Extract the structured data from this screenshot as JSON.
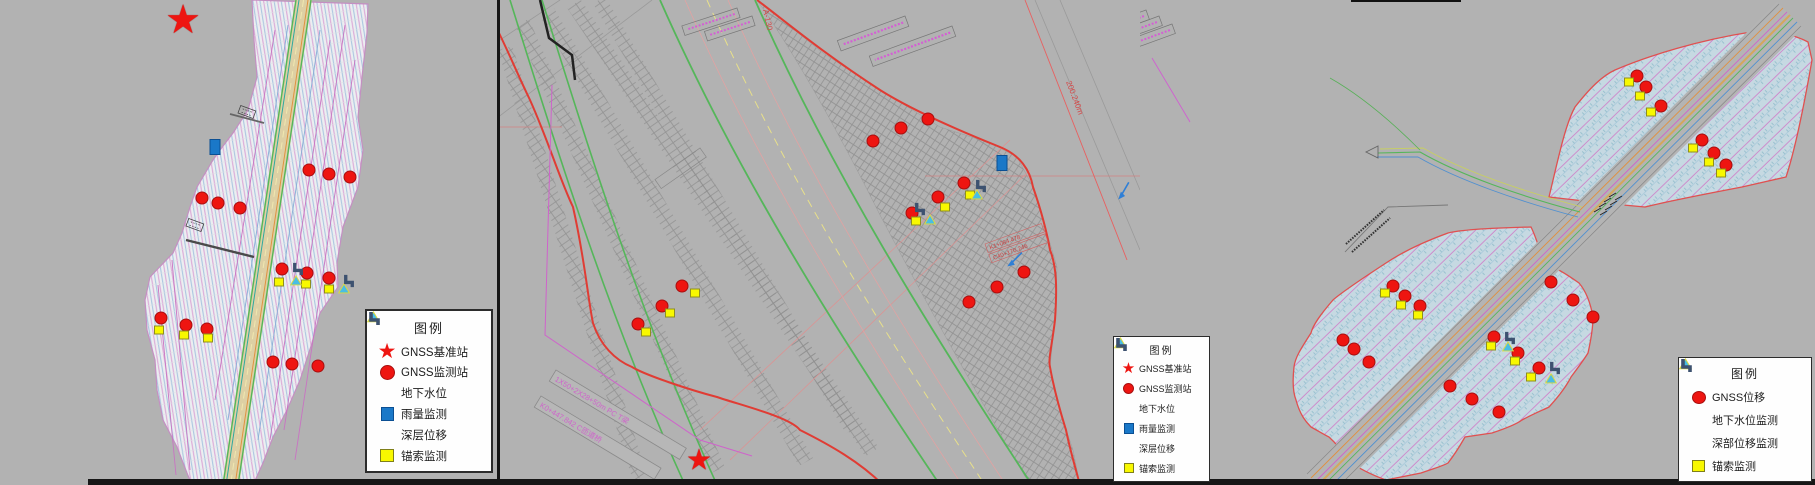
{
  "canvas": {
    "w": 1815,
    "h": 485,
    "bg": "#b2b2b2"
  },
  "colors": {
    "red": "#ee1511",
    "yellow": "#f8f800",
    "cyan": "#49bde4",
    "blue": "#1a78c8",
    "steel": "#3d5270",
    "boundary_red": "#e03c34",
    "road_green": "#55b65a",
    "road_tan": "#d6c492",
    "magenta": "#cf63cb",
    "hatch_blue_fill": "#c6d9e2",
    "left_hatch_fill": "#eceef1",
    "arrow_blue": "#2f7fd6"
  },
  "glyphs": {
    "star": "★"
  },
  "legends": [
    {
      "title": "图例",
      "x": 365,
      "y": 309,
      "size": "lg",
      "items": [
        {
          "icon": "star",
          "label": "GNSS基准站"
        },
        {
          "icon": "circle",
          "label": "GNSS监测站"
        },
        {
          "icon": "triangle",
          "label": "地下水位"
        },
        {
          "icon": "rain",
          "label": "雨量监测"
        },
        {
          "icon": "elbow",
          "label": "深层位移"
        },
        {
          "icon": "anchor",
          "label": "锚索监测"
        }
      ]
    },
    {
      "title": "图例",
      "x": 1113,
      "y": 336,
      "size": "sm",
      "items": [
        {
          "icon": "star",
          "label": "GNSS基准站"
        },
        {
          "icon": "circle",
          "label": "GNSS监测站"
        },
        {
          "icon": "triangle",
          "label": "地下水位"
        },
        {
          "icon": "rain",
          "label": "雨量监测"
        },
        {
          "icon": "elbow",
          "label": "深层位移"
        },
        {
          "icon": "anchor",
          "label": "锚索监测"
        }
      ]
    },
    {
      "title": "图例",
      "x": 1678,
      "y": 357,
      "size": "md",
      "items": [
        {
          "icon": "circle",
          "label": "GNSS位移"
        },
        {
          "icon": "triangle",
          "label": "地下水位监测"
        },
        {
          "icon": "elbow",
          "label": "深部位移监测"
        },
        {
          "icon": "anchor",
          "label": "锚索监测"
        }
      ]
    }
  ],
  "annotations": {
    "a130": "A-130",
    "chainage": "200.240m",
    "bridge1": "1X50+2X28+50m PC T梁",
    "bridge2": "K0+447.842 C匝道桥",
    "red1": "K1+084.478",
    "red2": "C40+170.246"
  },
  "markers": [
    {
      "t": "star",
      "x": 183,
      "y": 20,
      "s": 40
    },
    {
      "t": "star",
      "x": 699,
      "y": 460,
      "s": 29
    },
    {
      "t": "c",
      "x": 309,
      "y": 170
    },
    {
      "t": "c",
      "x": 329,
      "y": 174
    },
    {
      "t": "c",
      "x": 350,
      "y": 177
    },
    {
      "t": "c",
      "x": 202,
      "y": 198
    },
    {
      "t": "c",
      "x": 218,
      "y": 203
    },
    {
      "t": "c",
      "x": 240,
      "y": 208
    },
    {
      "t": "c",
      "x": 282,
      "y": 269
    },
    {
      "t": "c",
      "x": 307,
      "y": 273
    },
    {
      "t": "c",
      "x": 329,
      "y": 278
    },
    {
      "t": "c",
      "x": 161,
      "y": 318
    },
    {
      "t": "c",
      "x": 186,
      "y": 325
    },
    {
      "t": "c",
      "x": 207,
      "y": 329
    },
    {
      "t": "c",
      "x": 273,
      "y": 362
    },
    {
      "t": "c",
      "x": 292,
      "y": 364
    },
    {
      "t": "c",
      "x": 318,
      "y": 366
    },
    {
      "t": "c",
      "x": 638,
      "y": 324
    },
    {
      "t": "c",
      "x": 662,
      "y": 306
    },
    {
      "t": "c",
      "x": 682,
      "y": 286
    },
    {
      "t": "c",
      "x": 873,
      "y": 141
    },
    {
      "t": "c",
      "x": 901,
      "y": 128
    },
    {
      "t": "c",
      "x": 928,
      "y": 119
    },
    {
      "t": "c",
      "x": 912,
      "y": 213
    },
    {
      "t": "c",
      "x": 938,
      "y": 197
    },
    {
      "t": "c",
      "x": 964,
      "y": 183
    },
    {
      "t": "c",
      "x": 969,
      "y": 302
    },
    {
      "t": "c",
      "x": 997,
      "y": 287
    },
    {
      "t": "c",
      "x": 1024,
      "y": 272
    },
    {
      "t": "c",
      "x": 1637,
      "y": 76
    },
    {
      "t": "c",
      "x": 1646,
      "y": 87
    },
    {
      "t": "c",
      "x": 1661,
      "y": 106
    },
    {
      "t": "c",
      "x": 1702,
      "y": 140
    },
    {
      "t": "c",
      "x": 1714,
      "y": 153
    },
    {
      "t": "c",
      "x": 1726,
      "y": 165
    },
    {
      "t": "c",
      "x": 1393,
      "y": 286
    },
    {
      "t": "c",
      "x": 1405,
      "y": 296
    },
    {
      "t": "c",
      "x": 1420,
      "y": 306
    },
    {
      "t": "c",
      "x": 1343,
      "y": 340
    },
    {
      "t": "c",
      "x": 1354,
      "y": 349
    },
    {
      "t": "c",
      "x": 1369,
      "y": 362
    },
    {
      "t": "c",
      "x": 1551,
      "y": 282
    },
    {
      "t": "c",
      "x": 1573,
      "y": 300
    },
    {
      "t": "c",
      "x": 1593,
      "y": 317
    },
    {
      "t": "c",
      "x": 1494,
      "y": 337
    },
    {
      "t": "c",
      "x": 1518,
      "y": 353
    },
    {
      "t": "c",
      "x": 1539,
      "y": 368
    },
    {
      "t": "c",
      "x": 1450,
      "y": 386
    },
    {
      "t": "c",
      "x": 1472,
      "y": 399
    },
    {
      "t": "c",
      "x": 1499,
      "y": 412
    },
    {
      "t": "y",
      "x": 279,
      "y": 282
    },
    {
      "t": "y",
      "x": 306,
      "y": 284
    },
    {
      "t": "y",
      "x": 329,
      "y": 289
    },
    {
      "t": "y",
      "x": 159,
      "y": 330
    },
    {
      "t": "y",
      "x": 184,
      "y": 335
    },
    {
      "t": "y",
      "x": 208,
      "y": 338
    },
    {
      "t": "y",
      "x": 646,
      "y": 332
    },
    {
      "t": "y",
      "x": 670,
      "y": 313
    },
    {
      "t": "y",
      "x": 695,
      "y": 293
    },
    {
      "t": "y",
      "x": 916,
      "y": 221
    },
    {
      "t": "y",
      "x": 945,
      "y": 207
    },
    {
      "t": "y",
      "x": 970,
      "y": 195
    },
    {
      "t": "y",
      "x": 1629,
      "y": 82
    },
    {
      "t": "y",
      "x": 1640,
      "y": 96
    },
    {
      "t": "y",
      "x": 1651,
      "y": 112
    },
    {
      "t": "y",
      "x": 1693,
      "y": 148
    },
    {
      "t": "y",
      "x": 1709,
      "y": 162
    },
    {
      "t": "y",
      "x": 1721,
      "y": 173
    },
    {
      "t": "y",
      "x": 1385,
      "y": 293
    },
    {
      "t": "y",
      "x": 1401,
      "y": 305
    },
    {
      "t": "y",
      "x": 1418,
      "y": 315
    },
    {
      "t": "y",
      "x": 1491,
      "y": 346
    },
    {
      "t": "y",
      "x": 1515,
      "y": 361
    },
    {
      "t": "y",
      "x": 1531,
      "y": 377
    },
    {
      "t": "tri",
      "x": 290,
      "y": 275
    },
    {
      "t": "tri",
      "x": 338,
      "y": 283
    },
    {
      "t": "tri",
      "x": 924,
      "y": 214
    },
    {
      "t": "tri",
      "x": 971,
      "y": 189
    },
    {
      "t": "tri",
      "x": 1502,
      "y": 341
    },
    {
      "t": "tri",
      "x": 1545,
      "y": 373
    },
    {
      "t": "elb",
      "x": 291,
      "y": 262
    },
    {
      "t": "elb",
      "x": 342,
      "y": 274
    },
    {
      "t": "elb",
      "x": 913,
      "y": 202
    },
    {
      "t": "elb",
      "x": 974,
      "y": 179
    },
    {
      "t": "elb",
      "x": 1503,
      "y": 331
    },
    {
      "t": "elb",
      "x": 1548,
      "y": 361
    },
    {
      "t": "rain",
      "x": 215,
      "y": 147
    },
    {
      "t": "rain",
      "x": 1002,
      "y": 163
    },
    {
      "t": "ar",
      "x": 1008,
      "y": 249,
      "r": 20
    },
    {
      "t": "ar",
      "x": 1117,
      "y": 180,
      "r": 5
    }
  ]
}
